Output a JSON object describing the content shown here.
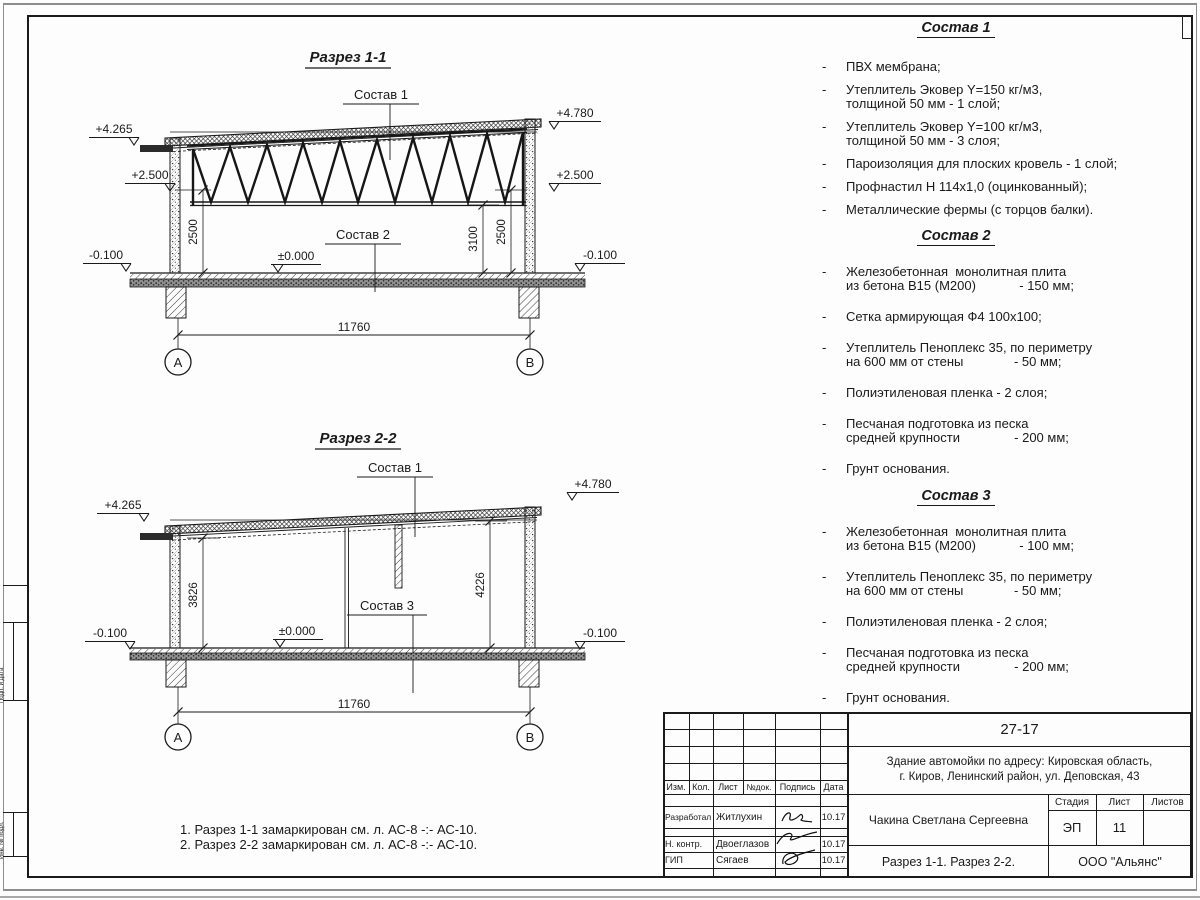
{
  "sections": {
    "s1": {
      "title": "Разрез 1-1",
      "sostav1": "Состав 1",
      "sostav2": "Состав 2",
      "elev_top_left": "+4.265",
      "elev_top_right": "+4.780",
      "elev_mid_left": "+2.500",
      "elev_mid_right": "+2.500",
      "elev_zero": "±0.000",
      "elev_base_left": "-0.100",
      "elev_base_right": "-0.100",
      "dim_left": "2500",
      "dim_right_inner": "3100",
      "dim_right": "2500",
      "dim_span": "11760",
      "axis_left": "А",
      "axis_right": "В"
    },
    "s2": {
      "title": "Разрез 2-2",
      "sostav1": "Состав 1",
      "sostav3": "Состав 3",
      "elev_top_left": "+4.265",
      "elev_top_right": "+4.780",
      "elev_zero": "±0.000",
      "elev_base_left": "-0.100",
      "elev_base_right": "-0.100",
      "dim_left": "3826",
      "dim_right": "4226",
      "dim_span": "11760",
      "axis_left": "А",
      "axis_right": "В"
    }
  },
  "notes": {
    "n1": "1. Разрез 1-1 замаркирован см. л. АС-8 -:- АС-10.",
    "n2": "2. Разрез 2-2 замаркирован см. л. АС-8 -:- АС-10."
  },
  "compositions": [
    {
      "title": "Состав 1",
      "items": [
        {
          "l1": "ПВХ мембрана;"
        },
        {
          "l1": "Утеплитель Эковер Y=150 кг/м3,",
          "l2": "толщиной 50 мм - 1 слой;"
        },
        {
          "l1": "Утеплитель Эковер Y=100 кг/м3,",
          "l2": "толщиной 50 мм - 3 слоя;"
        },
        {
          "l1": "Пароизоляция для плоских кровель - 1 слой;"
        },
        {
          "l1": "Профнастил Н 114х1,0 (оцинкованный);"
        },
        {
          "l1": "Металлические фермы (с торцов балки)."
        }
      ]
    },
    {
      "title": "Состав 2",
      "items": [
        {
          "l1": "Железобетонная  монолитная плита",
          "l2": "из бетона В15 (М200)            - 150 мм;"
        },
        {
          "l1": "Сетка армирующая Ф4 100х100;"
        },
        {
          "l1": "Утеплитель Пеноплекс 35, по периметру",
          "l2": "на 600 мм от стены              - 50 мм;"
        },
        {
          "l1": "Полиэтиленовая пленка - 2 слоя;"
        },
        {
          "l1": "Песчаная подготовка из песка",
          "l2": "средней крупности               - 200 мм;"
        },
        {
          "l1": "Грунт основания."
        }
      ]
    },
    {
      "title": "Состав 3",
      "items": [
        {
          "l1": "Железобетонная  монолитная плита",
          "l2": "из бетона В15 (М200)            - 100 мм;"
        },
        {
          "l1": "Утеплитель Пеноплекс 35, по периметру",
          "l2": "на 600 мм от стены              - 50 мм;"
        },
        {
          "l1": "Полиэтиленовая пленка - 2 слоя;"
        },
        {
          "l1": "Песчаная подготовка из песка",
          "l2": "средней крупности               - 200 мм;"
        },
        {
          "l1": "Грунт основания."
        }
      ]
    }
  ],
  "titleblock": {
    "doc_number": "27-17",
    "object_line1": "Здание автомойки по адресу: Кировская область,",
    "object_line2": "г. Киров, Ленинский район, ул. Деповская, 43",
    "col_izm": "Изм.",
    "col_kol": "Кол.",
    "col_list": "Лист",
    "col_ndok": "№док.",
    "col_podpis": "Подпись",
    "col_data": "Дата",
    "row1_role": "Разработал",
    "row1_name": "Житлухин",
    "row1_date": "10.17",
    "row2_role": "Н. контр.",
    "row2_name": "Двоеглазов",
    "row2_date": "10.17",
    "row3_role": "ГИП",
    "row3_name": "Сягаев",
    "row3_date": "10.17",
    "author": "Чакина Светлана Сергеевна",
    "stage_label": "Стадия",
    "sheet_label": "Лист",
    "sheets_label": "Листов",
    "stage": "ЭП",
    "sheet_number": "11",
    "sheets_total": "",
    "sheet_title": "Разрез 1-1. Разрез 2-2.",
    "company": "ООО \"Альянс\""
  },
  "stamp": {
    "v1": "Подп. и дата",
    "v2": "Инв. № подл."
  }
}
